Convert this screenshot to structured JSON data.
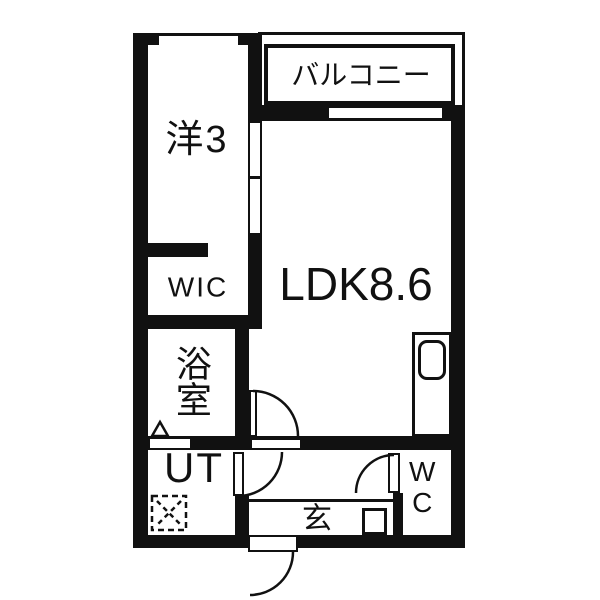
{
  "colors": {
    "wall": "#111111",
    "background": "#ffffff",
    "text": "#111111"
  },
  "rooms": {
    "balcony": {
      "label": "バルコニー"
    },
    "western_room": {
      "label": "洋3"
    },
    "walk_in_closet": {
      "label": "WIC"
    },
    "ldk": {
      "label": "LDK8.6"
    },
    "bathroom": {
      "label": "浴室"
    },
    "utility": {
      "label": "UT"
    },
    "entrance": {
      "label": "玄"
    },
    "toilet": {
      "label": "WC"
    }
  }
}
